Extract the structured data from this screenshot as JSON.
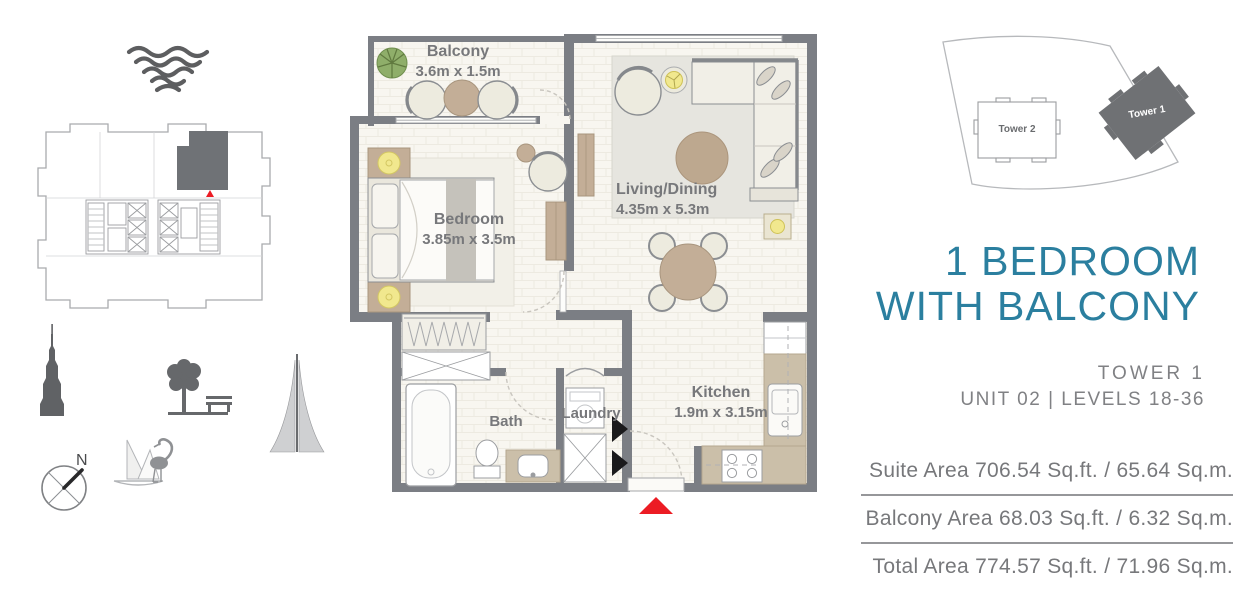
{
  "palette": {
    "accent_teal": "#2b7f9f",
    "text_gray": "#77787b",
    "wall_gray": "#7b7e84",
    "marker_red": "#ec1c24",
    "furniture_taupe": "#c3ae97",
    "counter_taupe": "#cbbfa9",
    "lamp_yellow": "#f1e88e"
  },
  "icons": {
    "logo": "waves-logo-icon",
    "landmarks": [
      "burj-khalifa-icon",
      "park-tree-bench-icon",
      "creek-tower-icon",
      "compass-icon",
      "sailboat-flamingo-icon"
    ],
    "markers": [
      "unit-location-triangle",
      "entry-triangle"
    ]
  },
  "compass": {
    "north": "N"
  },
  "site_plan": {
    "tower1_label": "Tower 1",
    "tower2_label": "Tower 2"
  },
  "floor_plan": {
    "balcony": {
      "name": "Balcony",
      "dims": "3.6m x 1.5m"
    },
    "living_dining": {
      "name": "Living/Dining",
      "dims": "4.35m x 5.3m"
    },
    "bedroom": {
      "name": "Bedroom",
      "dims": "3.85m x 3.5m"
    },
    "kitchen": {
      "name": "Kitchen",
      "dims": "1.9m x 3.15m"
    },
    "bath": {
      "name": "Bath"
    },
    "laundry": {
      "name": "Laundry"
    }
  },
  "unit_info": {
    "title_line1": "1 BEDROOM",
    "title_line2": "WITH BALCONY",
    "tower": "TOWER 1",
    "unit_levels": "UNIT 02 | LEVELS 18-36"
  },
  "areas": {
    "suite": "Suite Area 706.54 Sq.ft. / 65.64 Sq.m.",
    "balcony": "Balcony Area 68.03 Sq.ft. / 6.32 Sq.m.",
    "total": "Total Area 774.57 Sq.ft. / 71.96 Sq.m."
  }
}
